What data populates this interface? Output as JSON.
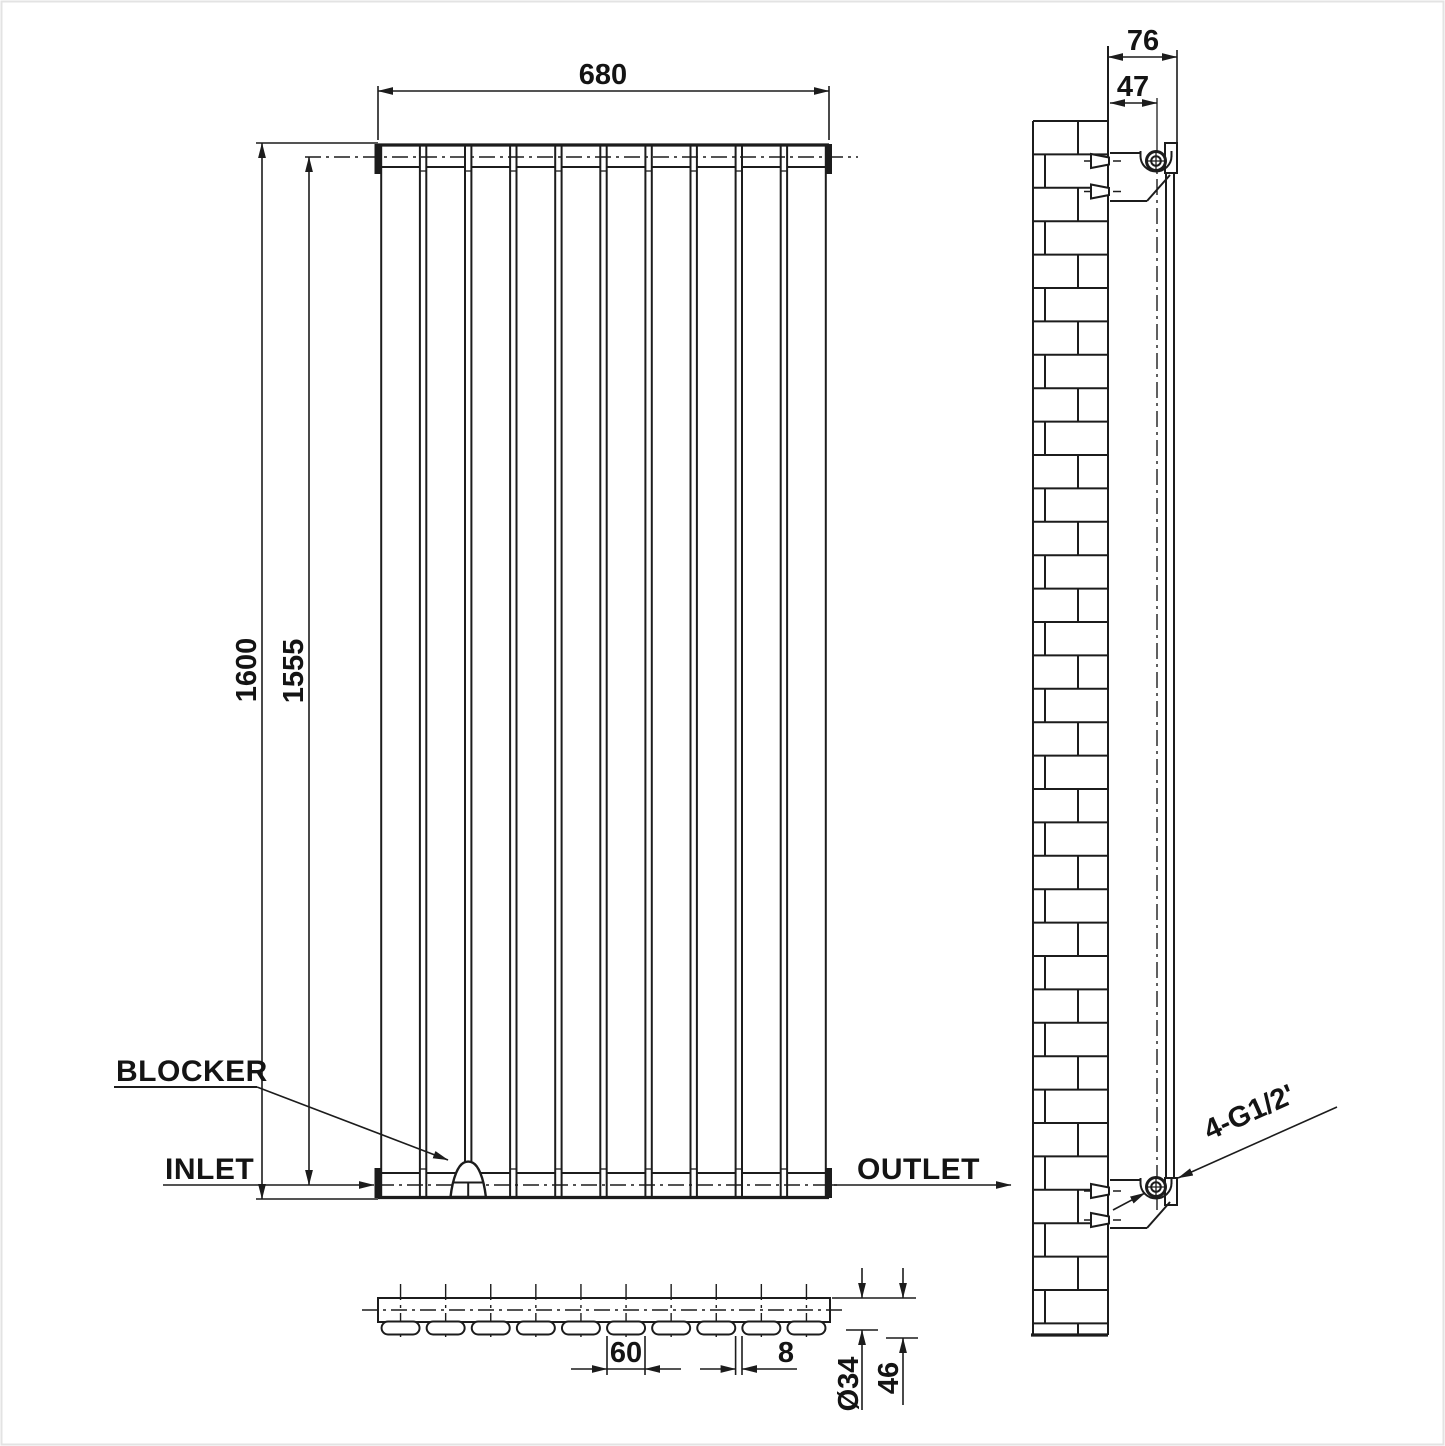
{
  "title": "Vertical panel radiator technical drawing",
  "front_view": {
    "panel_count": 10,
    "width_mm": "680",
    "height_mm": "1600",
    "inner_height_mm": "1555",
    "blocker_label": "BLOCKER",
    "inlet_label": "INLET",
    "outlet_label": "OUTLET"
  },
  "side_view": {
    "depth_mm": "76",
    "bracket_offset_mm": "47",
    "connection_label": "4-G1/2'"
  },
  "bottom_view": {
    "panel_width_mm": "60",
    "panel_gap_mm": "8",
    "tube_diameter": "Ø34",
    "total_depth_mm": "46"
  },
  "line_color": "#1c1c1c"
}
